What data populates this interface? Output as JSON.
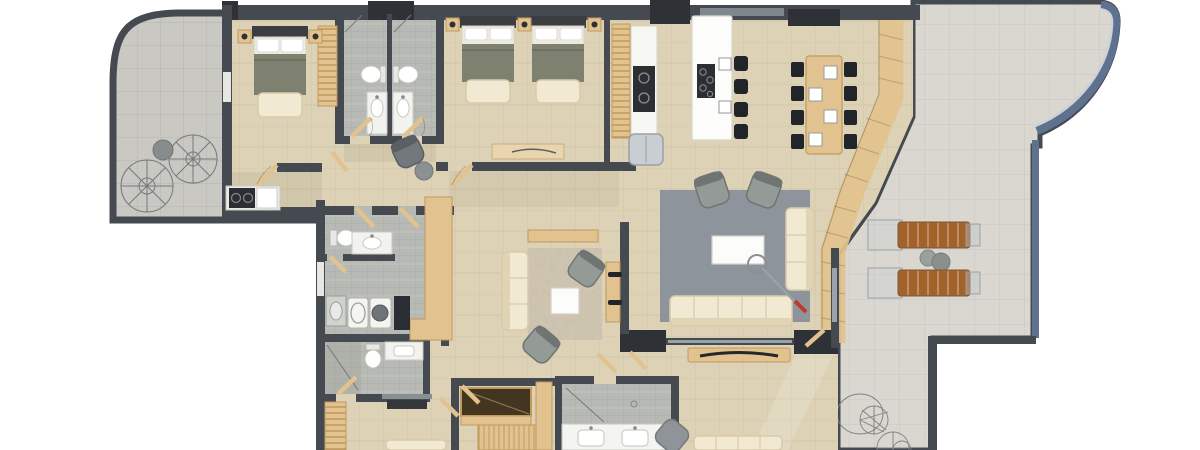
{
  "meta": {
    "image_type": "3d-rendered-apartment-floor-plan-top-view",
    "visible_text": "none"
  },
  "palette": {
    "wall": "#454a51",
    "wallDark": "#2e3237",
    "floor": "#ddd2b5",
    "floorDark": "#cfc2a2",
    "terraceL": "#c9c8c3",
    "terraceR": "#dad7d1",
    "bathFloor": "#b7bab4",
    "bathDark": "#a6a9a3",
    "wood": "#e2c28e",
    "woodDark": "#bf9a5e",
    "cream": "#f1e9d2",
    "creamDark": "#d9cba8",
    "olive": "#7e8170",
    "oliveDark": "#686b5c",
    "grayFurn": "#949a96",
    "grayFurnDark": "#6f7573",
    "rugBlue": "#8d949c",
    "rugCream": "#cfc5b0",
    "white": "#fbfbf9",
    "black": "#212429",
    "brown": "#a4622b",
    "rail": "#5e7290",
    "steel": "#c9ced3",
    "red": "#c0392b",
    "voidBrown": "#43351f",
    "tvDark": "#33363b"
  },
  "scene": {
    "rooms": [
      {
        "id": "terrace-west",
        "type": "terrace",
        "features": [
          "curved parapet",
          "two wireframe patio chairs",
          "round table"
        ]
      },
      {
        "id": "bedroom-1",
        "type": "bedroom",
        "features": [
          "double bed",
          "foot bench",
          "ladder wardrobe",
          "two nightstands",
          "kitchenette counter"
        ]
      },
      {
        "id": "bathroom-1",
        "type": "bathroom",
        "features": [
          "toilet",
          "vanity sink",
          "shower"
        ]
      },
      {
        "id": "bathroom-2",
        "type": "bathroom",
        "features": [
          "toilet",
          "vanity sink",
          "shower"
        ]
      },
      {
        "id": "bedroom-2",
        "type": "twin bedroom",
        "features": [
          "two single beds",
          "foot benches",
          "three nightstands",
          "desk"
        ]
      },
      {
        "id": "kitchen",
        "type": "kitchen",
        "features": [
          "pantry shelving",
          "counter with cooktop",
          "fridge",
          "white island with hob",
          "four bar stools",
          "plates"
        ]
      },
      {
        "id": "dining",
        "type": "dining room",
        "features": [
          "wood table",
          "eight black chairs",
          "four place settings"
        ]
      },
      {
        "id": "living",
        "type": "living room",
        "features": [
          "blue mottled rug",
          "two gray armchairs",
          "white coffee table",
          "two cream sofas",
          "arc floor lamp with red tip"
        ]
      },
      {
        "id": "family-lounge",
        "type": "sitting room",
        "features": [
          "cream rug",
          "cream sofa",
          "two gray armchairs",
          "white coffee table",
          "console",
          "media wall with sideboard"
        ]
      },
      {
        "id": "hallway",
        "type": "hall",
        "features": [
          "office chair",
          "round pouf",
          "wood doors"
        ]
      },
      {
        "id": "laundry-bath",
        "type": "bathroom + laundry",
        "features": [
          "toilet",
          "vanity",
          "washer",
          "dryer",
          "utility sink",
          "dark cabinet"
        ]
      },
      {
        "id": "bathroom-4",
        "type": "bathroom",
        "features": [
          "shower",
          "toilet",
          "vanity"
        ]
      },
      {
        "id": "bedroom-3",
        "type": "bedroom",
        "features": [
          "ladder wardrobe",
          "TV console",
          "bed (cut at edge)"
        ]
      },
      {
        "id": "stairs",
        "type": "staircase",
        "features": [
          "stairwell void",
          "wood treads"
        ]
      },
      {
        "id": "bathroom-5",
        "type": "bathroom",
        "features": [
          "glass shower",
          "double-sink vanity"
        ]
      },
      {
        "id": "media-room",
        "type": "lounge",
        "features": [
          "wood TV console with curved TV",
          "gray pouf",
          "cream sofa (cut at edge)",
          "window wall"
        ]
      },
      {
        "id": "terrace-east",
        "type": "terrace",
        "features": [
          "curved blue balustrade",
          "two brown sun loungers",
          "round side tables",
          "wireframe fans"
        ]
      }
    ]
  }
}
